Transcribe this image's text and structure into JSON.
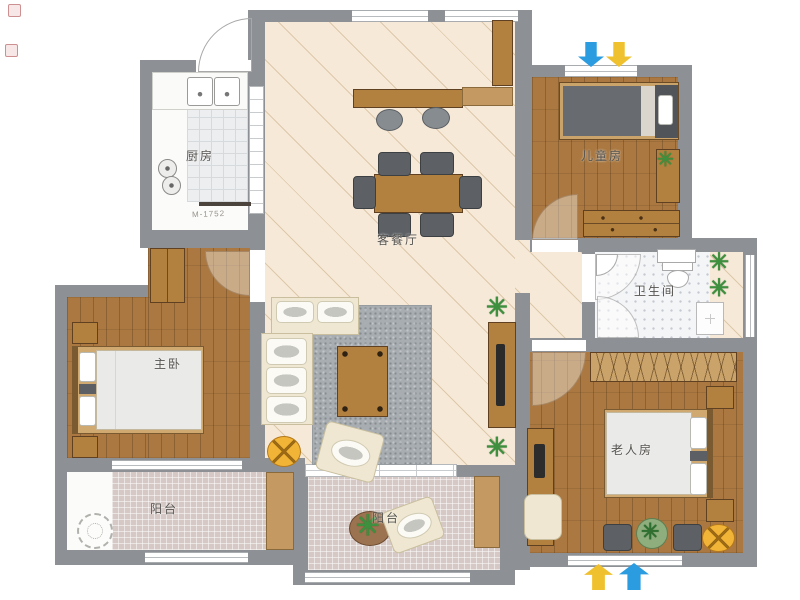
{
  "floorplan": {
    "rooms": {
      "kitchen": {
        "label": "厨房"
      },
      "living_dining": {
        "label": "客餐厅"
      },
      "children_room": {
        "label": "儿童房"
      },
      "bathroom": {
        "label": "卫生间"
      },
      "master_bedroom": {
        "label": "主卧"
      },
      "elderly_room": {
        "label": "老人房"
      },
      "balcony_left": {
        "label": "阳台"
      },
      "balcony_center": {
        "label": "阳台"
      }
    },
    "annotations": {
      "kitchen_dimension": "M-1752"
    },
    "glyphs": {
      "plant": "✳"
    },
    "orientation_arrows": {
      "top": [
        "arrow-down-blue",
        "arrow-down-yellow"
      ],
      "bottom": [
        "arrow-up-yellow",
        "arrow-up-blue"
      ]
    },
    "colors": {
      "wall": "#8d9196",
      "wood_floor": "#aa7840",
      "living_floor": "#f6e9d8",
      "balcony_tile": "#d6c8c4",
      "bathroom_floor": "#f4f5f7",
      "arrow_blue": "#2b9ce0",
      "arrow_yellow": "#f0c12e",
      "plant_green": "#3e8f3e",
      "accent_table_yellow": "#f2b437"
    }
  }
}
